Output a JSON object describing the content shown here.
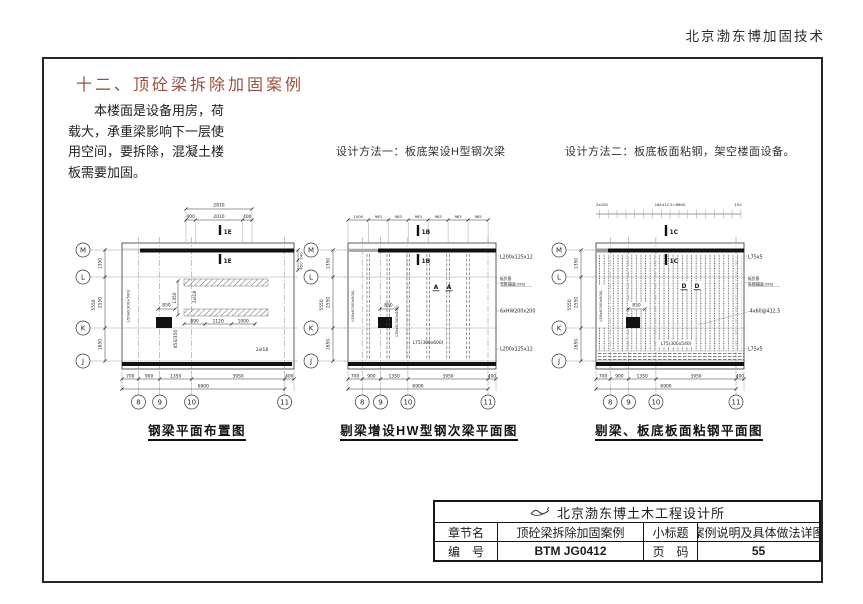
{
  "header": {
    "title": "北京渤东博加固技术"
  },
  "section": {
    "title": "十二、顶砼梁拆除加固案例"
  },
  "intro": {
    "lines": [
      "　　本楼面是设备用房，荷",
      "载大，承重梁影响下一层使",
      "用空间，要拆除，混凝土楼",
      "板需要加固。"
    ]
  },
  "methods": [
    "设计方法一：板底架设H型钢次梁",
    "设计方法二：板底板面粘钢，架空楼面设备。"
  ],
  "colors": {
    "section_title": "#9a4f3c",
    "linework": "#1d1d1d",
    "beam_fill": "#111111"
  },
  "axis": {
    "bubbles": [
      "M",
      "L",
      "K",
      "J"
    ],
    "dims": [
      "1350",
      "2550",
      "1650"
    ],
    "total": "5550"
  },
  "grid": {
    "bubbles": [
      "8",
      "9",
      "10",
      "11"
    ],
    "dims": [
      "700",
      "900",
      "1350",
      "3950",
      "400"
    ],
    "total": "6900"
  },
  "d1": {
    "caption": "钢梁平面布置图",
    "top_total": "2810",
    "top_dims": [
      "400",
      "2010",
      "400"
    ],
    "mark": "1E",
    "mid_dims": [
      "890",
      "1120",
      "1000"
    ],
    "dim_1350": "1350",
    "dim_850": "850",
    "col_dim": "850/350",
    "beam_label": "2xI18",
    "angle_label": "L50x6(300+500)",
    "right_dims": [
      "240",
      "450"
    ]
  },
  "d2": {
    "caption": "剔梁增设HW型钢次梁平面图",
    "top_dims": [
      "1000",
      "983",
      "983",
      "983",
      "983",
      "983",
      "985"
    ],
    "mark": "1B",
    "detail_mark": "A",
    "dim_850": "850",
    "angle_label": "L50x6(300x500)",
    "angle_label2": "L50x6(300x500)",
    "beam_label": "L75(300x600)",
    "ann": [
      "L200x125x12",
      "板负筋",
      "弯筋锚固(350)",
      "6xHW200x200",
      "L200x125x12"
    ]
  },
  "d3": {
    "caption": "剔梁、板底板面粘钢平面图",
    "top_dims": [
      "2x150",
      "16x412.5=6600",
      "150"
    ],
    "mark": "1C",
    "detail_mark": "D",
    "dim_850": "850",
    "angle_label": "L50x6(300x500)",
    "beam_label": "L75(300x540)",
    "ann": [
      "L75x5",
      "板负筋",
      "粘钢锚固(350)",
      "-4x60@412.5",
      "L75x5"
    ]
  },
  "titleblock": {
    "org": "北京渤东博土木工程设计所",
    "row1": {
      "label": "章节名",
      "value": "顶砼梁拆除加固案例",
      "label2": "小标题",
      "value2": "案例说明及具体做法详图"
    },
    "row2": {
      "label": "编　号",
      "value": "BTM JG0412",
      "label2": "页　码",
      "value2": "55"
    }
  }
}
